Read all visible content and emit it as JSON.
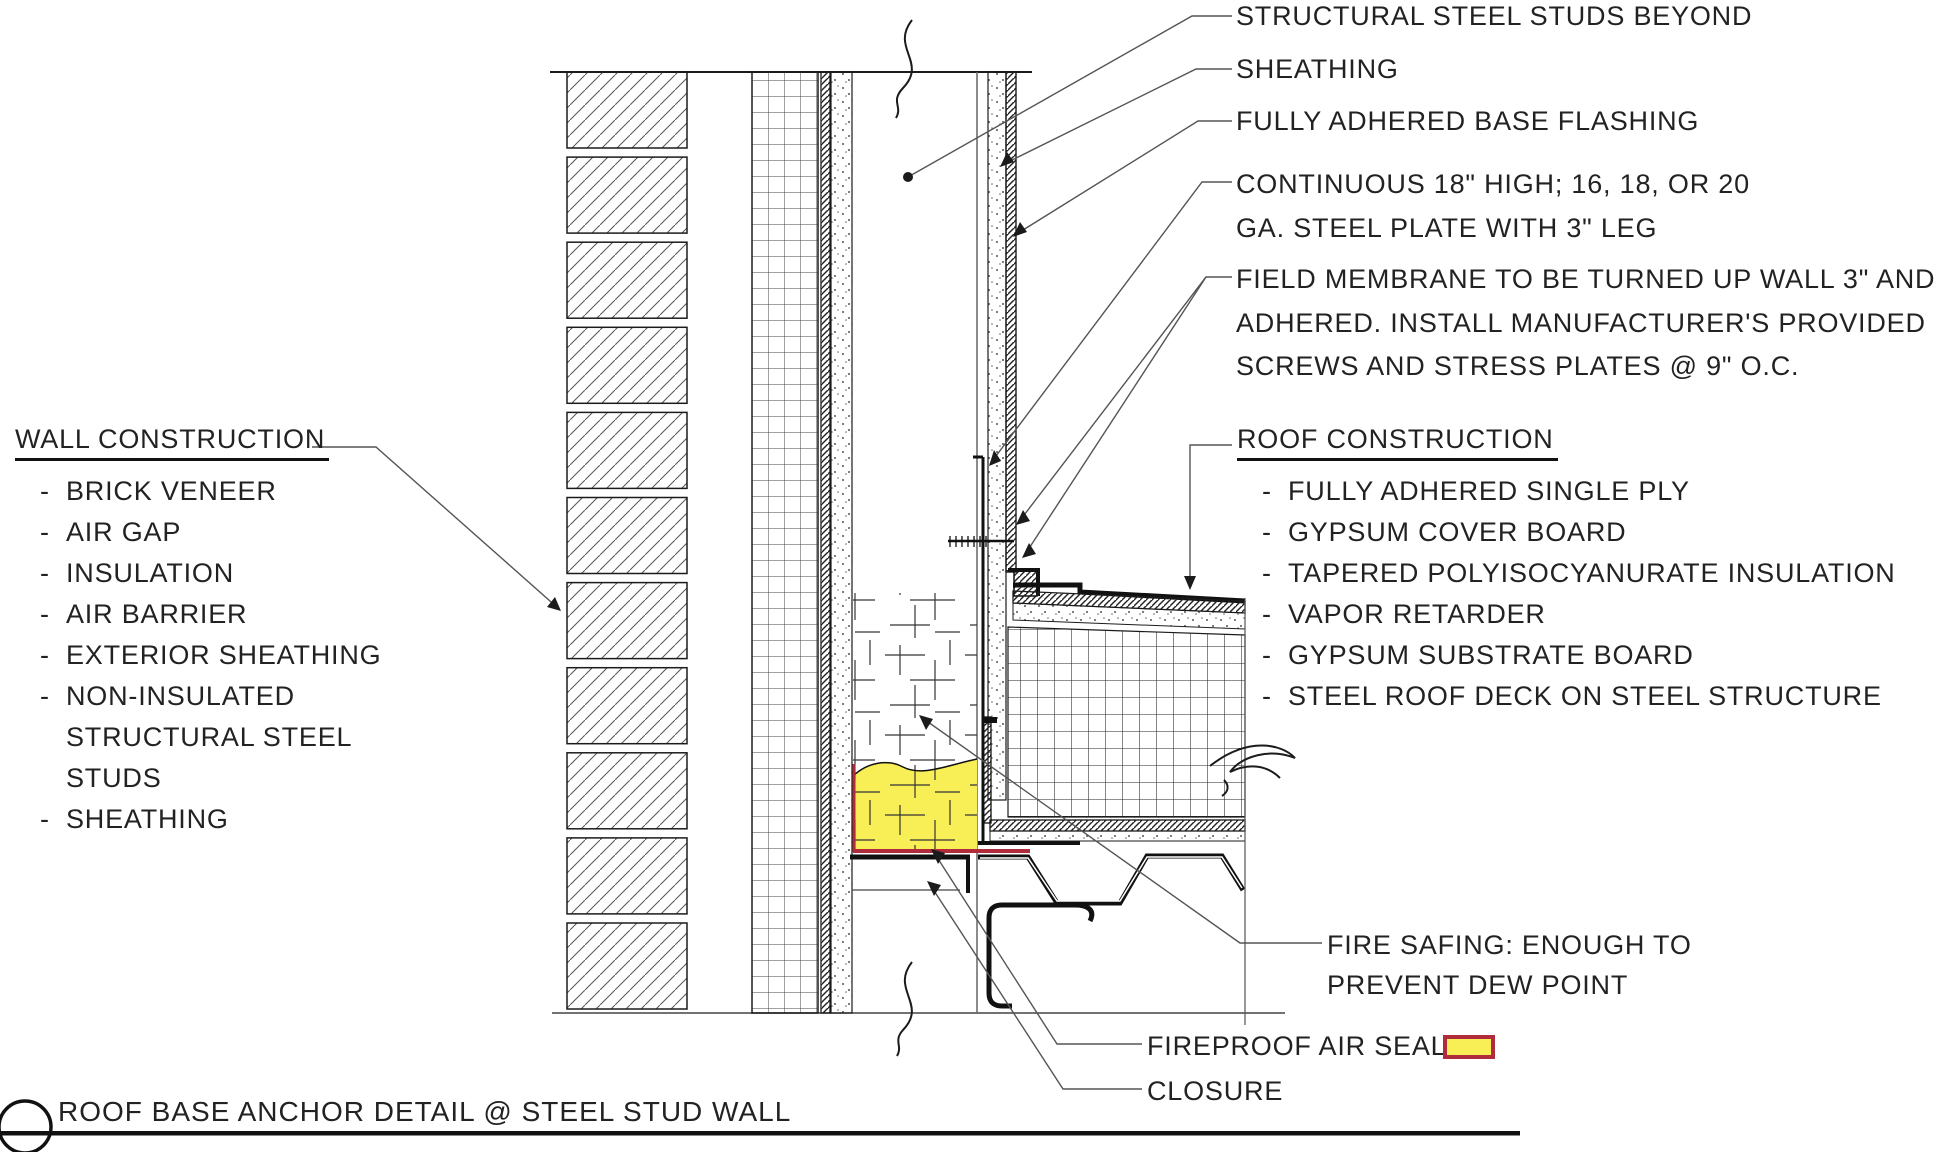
{
  "sheet": {
    "title": "ROOF BASE ANCHOR DETAIL @ STEEL STUD WALL",
    "bullet": "-"
  },
  "callouts_right": [
    {
      "name": "structural-steel-studs-beyond",
      "lines": [
        "STRUCTURAL STEEL STUDS BEYOND"
      ]
    },
    {
      "name": "sheathing",
      "lines": [
        "SHEATHING"
      ]
    },
    {
      "name": "fully-adhered-base-flashing",
      "lines": [
        "FULLY ADHERED BASE FLASHING"
      ]
    },
    {
      "name": "continuous-steel-plate",
      "lines": [
        "CONTINUOUS 18\" HIGH; 16, 18, OR 20",
        "GA. STEEL PLATE WITH 3\" LEG"
      ]
    },
    {
      "name": "field-membrane",
      "lines": [
        "FIELD MEMBRANE TO BE TURNED UP WALL 3\" AND",
        "ADHERED. INSTALL MANUFACTURER'S PROVIDED",
        "SCREWS AND STRESS PLATES @ 9\" O.C."
      ]
    }
  ],
  "wall_construction": {
    "heading": "WALL CONSTRUCTION",
    "items": [
      "BRICK VENEER",
      "AIR GAP",
      "INSULATION",
      "AIR BARRIER",
      "EXTERIOR SHEATHING",
      "NON-INSULATED STRUCTURAL STEEL STUDS",
      "SHEATHING"
    ]
  },
  "roof_construction": {
    "heading": "ROOF CONSTRUCTION",
    "items": [
      "FULLY ADHERED SINGLE PLY",
      "GYPSUM COVER BOARD",
      "TAPERED POLYISOCYANURATE INSULATION",
      "VAPOR RETARDER",
      "GYPSUM SUBSTRATE BOARD",
      "STEEL ROOF DECK ON STEEL STRUCTURE"
    ]
  },
  "callouts_bottom": {
    "fire_safing": {
      "lines": [
        "FIRE SAFING: ENOUGH TO",
        "PREVENT DEW POINT"
      ]
    },
    "fireproof_air_seal": {
      "label": "FIREPROOF AIR SEAL"
    },
    "closure": {
      "label": "CLOSURE"
    }
  },
  "colors": {
    "line": "#1b1b1b",
    "leader": "#555555",
    "safing_yellow": "#f8ee55",
    "seal_red": "#b02c3c",
    "text": "#222222"
  }
}
